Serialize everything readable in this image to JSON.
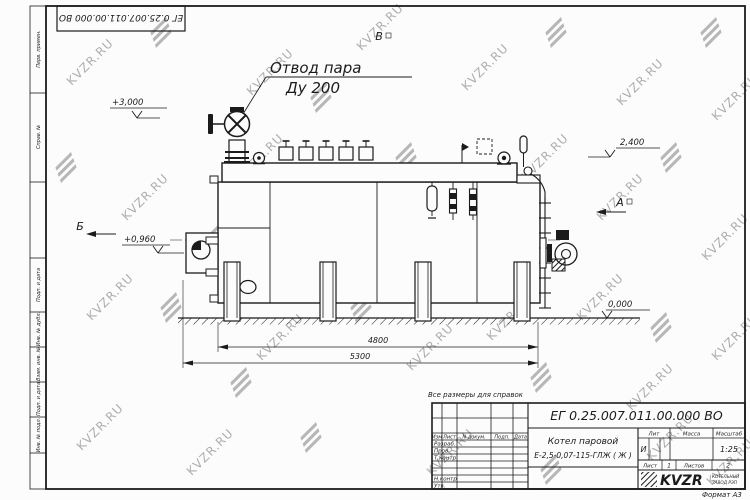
{
  "watermark": {
    "text": "KVZR.RU"
  },
  "frame": {
    "top_stamp": "ЕГ 0.25.007.011.00.000  ВО",
    "left_stamps": [
      "Перв. примен.",
      "Справ. №",
      "Подп. и дата",
      "Инв. № дубл.",
      "Взам. инв. №",
      "Подп. и дата",
      "Инв. № подл."
    ],
    "format_note": "Формат А3"
  },
  "drawing": {
    "steam_outlet_label": {
      "line1": "Отвод пара",
      "line2": "Ду 200"
    },
    "elevations": {
      "top": "+3,000",
      "burner": "+0,960",
      "rear": "2,400",
      "ground": "0,000"
    },
    "sections": {
      "b": "Б",
      "v": "В",
      "a": "А"
    },
    "dimensions": {
      "inner": "4800",
      "outer": "5300"
    }
  },
  "title_block": {
    "note": "Все размеры для справок",
    "doc_number": "ЕГ 0.25.007.011.00.000  ВО",
    "product_name": {
      "line1": "Котел паровой",
      "line2": "Е-2,5-0,07-115-ГЛЖ ( Ж )"
    },
    "columns": {
      "izm": "Изм",
      "list": "Лист",
      "ndoc": "N докум.",
      "podp": "Подп.",
      "data": "Дата"
    },
    "rows": {
      "razrab": "Разраб.",
      "prov": "Пров.",
      "tkontr": "Т.контр",
      "nkontr": "Н.контр",
      "utv": "Утв."
    },
    "lit": {
      "label": "Лит",
      "value": "И"
    },
    "massa": {
      "label": "Масса"
    },
    "scale": {
      "label": "Масштаб",
      "value": "1:25"
    },
    "sheet": {
      "label": "Лист",
      "value": "1"
    },
    "sheets": {
      "label": "Листов",
      "value": "2"
    },
    "company": {
      "name": "KVZR",
      "sub1": "КОТЕЛЬНЫЙ",
      "sub2": "ЗАВОД РЭП"
    }
  }
}
